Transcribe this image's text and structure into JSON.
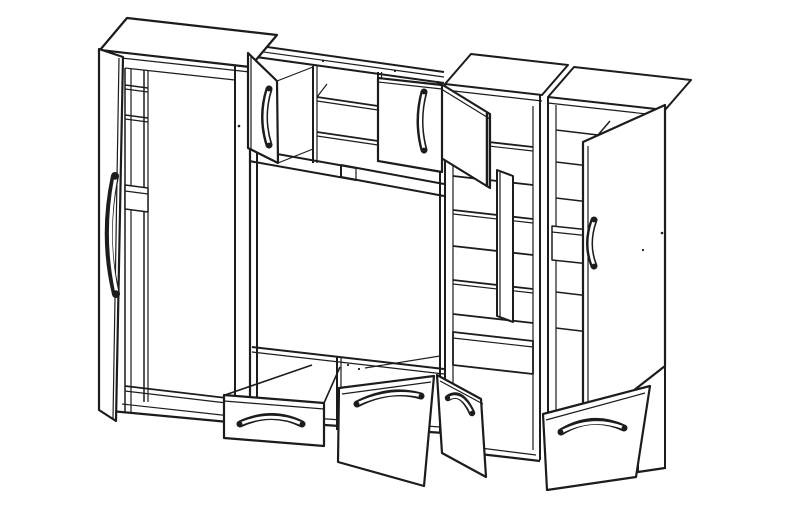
{
  "illustration": {
    "description": "Black-and-white isometric line drawing of a living-room wall unit with open doors, drawers and shelves",
    "background": "#ffffff",
    "line_color": "#1c1c1c",
    "canvas": {
      "width": 787,
      "height": 505
    },
    "components": [
      "left-tall-wardrobe",
      "wardrobe-open-door",
      "wardrobe-interior-shelves",
      "upper-wall-cabinet",
      "wall-cabinet-left-door",
      "wall-cabinet-open-shelves",
      "wall-cabinet-right-door",
      "floating-shelf-rails",
      "tv-open-bay",
      "base-cabinet",
      "open-drawer",
      "open-flap-door",
      "open-base-door",
      "display-cabinet",
      "display-cabinet-upper-door",
      "display-cabinet-lower-door",
      "right-tall-cabinet",
      "right-cabinet-open-door",
      "right-cabinet-bottom-door",
      "curved-door-handles"
    ],
    "shapes": [
      {
        "n": "midwall-top-rail-back",
        "k": "line",
        "p": "246,44 444,72",
        "w": 2
      },
      {
        "n": "midwall-top-rail-mid",
        "k": "line",
        "p": "249,50 444,77",
        "w": 1.2
      },
      {
        "n": "midwall-top-rail-front",
        "k": "line",
        "p": "249,56 444,83",
        "w": 2
      },
      {
        "n": "wallcab-divider-left",
        "k": "line",
        "p": "313,66 313,163",
        "w": 2
      },
      {
        "n": "wallcab-divider-left-inner",
        "k": "line",
        "p": "317,66 317,163",
        "w": 1.2
      },
      {
        "n": "wallcab-shelf-upper",
        "k": "line",
        "p": "317,97 378,106",
        "w": 1.8
      },
      {
        "n": "wallcab-shelf-upper-edge",
        "k": "line",
        "p": "317,101 378,110",
        "w": 1.2
      },
      {
        "n": "wallcab-shelf-depth-tick-left",
        "k": "line",
        "p": "317,97 327,84",
        "w": 1.2
      },
      {
        "n": "wallcab-shelf-depth-tick-right",
        "k": "line",
        "p": "378,106 388,93",
        "w": 1.2
      },
      {
        "n": "wallcab-shelf-lower",
        "k": "line",
        "p": "317,132 378,141",
        "w": 1.8
      },
      {
        "n": "wallcab-shelf-lower-edge",
        "k": "line",
        "p": "317,136 378,145",
        "w": 1.2
      },
      {
        "n": "wallcab-divider-right",
        "k": "line",
        "p": "378,72 378,162",
        "w": 2
      },
      {
        "n": "wallcab-divider-right-inner",
        "k": "line",
        "p": "381.5,72 381.5,162",
        "w": 1.2
      },
      {
        "n": "wallcab-bottom-rail-top",
        "k": "line",
        "p": "249,149 356,168",
        "w": 2
      },
      {
        "n": "wallcab-bottom-rail-bottom",
        "k": "line",
        "p": "249,161 356,180",
        "w": 2
      },
      {
        "n": "floating-rail-top",
        "k": "line",
        "p": "341,165 444,184",
        "w": 2
      },
      {
        "n": "floating-rail-bottom",
        "k": "line",
        "p": "341,177 444,196",
        "w": 2
      },
      {
        "n": "floating-rail-end",
        "k": "line",
        "p": "341,165 341,177",
        "w": 2
      },
      {
        "n": "floating-rail-divider",
        "k": "line",
        "p": "356,168 356,181",
        "w": 1.2
      },
      {
        "n": "tv-bay-left-wall",
        "k": "line",
        "p": "257,70 257,420",
        "w": 2
      },
      {
        "n": "tv-bay-right-wall",
        "k": "line",
        "p": "440,86 440,433",
        "w": 2
      },
      {
        "n": "tv-base-top-edge",
        "k": "line",
        "p": "252,347 444,369",
        "w": 2
      },
      {
        "n": "tv-base-top-inner",
        "k": "line",
        "p": "252,352 444,374",
        "w": 1.2
      },
      {
        "n": "base-divider",
        "k": "line",
        "p": "337,356 337,430",
        "w": 2
      },
      {
        "n": "base-divider-inner",
        "k": "line",
        "p": "341,357 341,430",
        "w": 1.2
      },
      {
        "n": "base-right-depth-edge",
        "k": "line",
        "p": "365,368 440,356",
        "w": 1.2
      },
      {
        "n": "base-bottom-edge",
        "k": "line",
        "p": "250,420 444,433",
        "w": 2.2
      },
      {
        "n": "base-plinth-line",
        "k": "line",
        "p": "256,414 440,427",
        "w": 1.2
      },
      {
        "n": "right-cabinet-top-panel",
        "k": "poly",
        "p": "548,97 574,67 691,80 665,110",
        "w": 2
      },
      {
        "n": "right-cabinet-top-front-edge",
        "k": "line",
        "p": "548,103 665,116",
        "w": 1.2
      },
      {
        "n": "right-cabinet-left-edge",
        "k": "line",
        "p": "548,97 548,458",
        "w": 2
      },
      {
        "n": "right-cabinet-right-edge",
        "k": "line",
        "p": "665,110 665,469",
        "w": 2
      },
      {
        "n": "right-cabinet-inner-left",
        "k": "line",
        "p": "556,105 556,452",
        "w": 1.2
      },
      {
        "n": "right-cabinet-shelf-1",
        "k": "line",
        "p": "556,130 598,135 610,121",
        "w": 1.5
      },
      {
        "n": "right-cabinet-shelf-2",
        "k": "line",
        "p": "556,162 598,167 610,153",
        "w": 1.5
      },
      {
        "n": "right-cabinet-shelf-3",
        "k": "line",
        "p": "556,198 598,203 610,189",
        "w": 1.5
      },
      {
        "n": "right-cabinet-drawer-box",
        "k": "poly",
        "p": "552,226 590,230 590,264 552,260",
        "w": 1.5
      },
      {
        "n": "right-cabinet-drawer-box-edge",
        "k": "line",
        "p": "552,232 590,236",
        "w": 1.2
      },
      {
        "n": "right-cabinet-shelf-4",
        "k": "line",
        "p": "556,292 598,297 610,283",
        "w": 1.5
      },
      {
        "n": "right-cabinet-shelf-5",
        "k": "line",
        "p": "556,328 598,333 610,319",
        "w": 1.5
      },
      {
        "n": "right-cabinet-bottom-edge",
        "k": "line",
        "p": "548,458 638,472 665,468",
        "w": 2.2
      },
      {
        "n": "right-cabinet-plinth-line",
        "k": "line",
        "p": "552,452 634,466",
        "w": 1.2
      },
      {
        "n": "right-cabinet-side-lower-edge",
        "k": "line",
        "p": "638,380 638,472",
        "w": 2
      },
      {
        "n": "right-cabinet-open-door",
        "k": "poly",
        "p": "583,142 665,105 665,366 583,430",
        "w": 2.2
      },
      {
        "n": "right-cabinet-door-edge",
        "k": "line",
        "p": "588,146 588,426",
        "w": 1.2
      },
      {
        "n": "right-cabinet-door-handle",
        "k": "path",
        "d": "M594,220 Q585,244 594,266",
        "w": 7
      },
      {
        "n": "right-cabinet-door-handle-inner",
        "k": "path",
        "d": "M594,221 Q586,244 594,265",
        "w": 3,
        "c": "#ffffff"
      },
      {
        "n": "right-cabinet-door-handle-cap-top",
        "k": "dot",
        "p": "594,220,2.4"
      },
      {
        "n": "right-cabinet-door-handle-cap-bottom",
        "k": "dot",
        "p": "594,266,2.4"
      },
      {
        "n": "display-cabinet-top-panel",
        "k": "poly",
        "p": "445,84 471,54 568,65 542,95",
        "w": 2
      },
      {
        "n": "display-cabinet-top-front-edge",
        "k": "line",
        "p": "445,90 542,101",
        "w": 1.2
      },
      {
        "n": "display-cabinet-left-edge",
        "k": "line",
        "p": "445,84 445,450",
        "w": 2
      },
      {
        "n": "display-cabinet-right-edge",
        "k": "line",
        "p": "540,95 540,460",
        "w": 2
      },
      {
        "n": "display-cabinet-inner-left",
        "k": "line",
        "p": "453,96 453,440",
        "w": 1.2
      },
      {
        "n": "display-cabinet-inner-right",
        "k": "line",
        "p": "533,106 533,450",
        "w": 1.2
      },
      {
        "n": "display-shelf-1",
        "k": "line",
        "p": "453,138 533,147",
        "w": 1.8
      },
      {
        "n": "display-shelf-1-edge",
        "k": "line",
        "p": "453,142 533,151",
        "w": 1.2
      },
      {
        "n": "display-shelf-2",
        "k": "line",
        "p": "453,176 533,185",
        "w": 1.8
      },
      {
        "n": "display-shelf-3",
        "k": "line",
        "p": "453,210 533,219",
        "w": 1.8
      },
      {
        "n": "display-shelf-3-edge",
        "k": "line",
        "p": "453,214 533,223",
        "w": 1.2
      },
      {
        "n": "display-shelf-4",
        "k": "line",
        "p": "453,246 533,255",
        "w": 1.8
      },
      {
        "n": "display-shelf-5",
        "k": "line",
        "p": "453,280 533,289",
        "w": 1.8
      },
      {
        "n": "display-shelf-5-edge",
        "k": "line",
        "p": "453,284 533,293",
        "w": 1.2
      },
      {
        "n": "display-shelf-6",
        "k": "line",
        "p": "453,314 533,323",
        "w": 1.8
      },
      {
        "n": "display-bottom-drawer-box",
        "k": "poly",
        "p": "453,332 533,341 533,374 453,365",
        "w": 1.8
      },
      {
        "n": "display-bottom-drawer-edge",
        "k": "line",
        "p": "453,338 533,347",
        "w": 1.2
      },
      {
        "n": "display-cabinet-bottom-edge",
        "k": "line",
        "p": "445,450 540,461",
        "w": 2.2
      },
      {
        "n": "display-cabinet-plinth-line",
        "k": "line",
        "p": "449,444 536,455",
        "w": 1.2
      },
      {
        "n": "display-upper-door",
        "k": "poly",
        "p": "438,82 490,114 490,188 438,156",
        "w": 2.2
      },
      {
        "n": "display-upper-door-thickness",
        "k": "line",
        "p": "438,87 490,119",
        "w": 1.2
      },
      {
        "n": "display-upper-door-free-edge",
        "k": "line",
        "p": "487,113 487,187",
        "w": 2.5
      },
      {
        "n": "display-lower-door",
        "k": "poly",
        "p": "497,170 513,176 513,322 497,316",
        "w": 2
      },
      {
        "n": "display-lower-door-edge",
        "k": "line",
        "p": "500,172 500,318",
        "w": 1.2
      },
      {
        "n": "wardrobe-top-panel",
        "k": "poly",
        "p": "100,50 127,18 277,35 250,67",
        "w": 2.2
      },
      {
        "n": "wardrobe-top-front-edge",
        "k": "line",
        "p": "103,56 250,72",
        "w": 1.2
      },
      {
        "n": "wardrobe-left-edge",
        "k": "line",
        "p": "100,50 100,410",
        "w": 2.2
      },
      {
        "n": "wardrobe-right-edge",
        "k": "line",
        "p": "250,67 250,424",
        "w": 2.2
      },
      {
        "n": "wardrobe-bottom-edge",
        "k": "line",
        "p": "100,410 250,424",
        "w": 2.2
      },
      {
        "n": "wardrobe-plinth-line",
        "k": "line",
        "p": "122,404 240,417",
        "w": 1.2
      },
      {
        "n": "wardrobe-right-stile",
        "k": "line",
        "p": "235,65 235,421",
        "w": 2
      },
      {
        "n": "wardrobe-interior-top",
        "k": "line",
        "p": "125,68 235,80",
        "w": 1.2
      },
      {
        "n": "wardrobe-interior-left",
        "k": "line",
        "p": "125,68 125,412",
        "w": 1.5
      },
      {
        "n": "wardrobe-interior-left-inner",
        "k": "line",
        "p": "131,69 131,413",
        "w": 1.2
      },
      {
        "n": "wardrobe-partition",
        "k": "line",
        "p": "144,70 144,402",
        "w": 1.5
      },
      {
        "n": "wardrobe-partition-inner",
        "k": "line",
        "p": "148,70 148,402",
        "w": 1.2
      },
      {
        "n": "wardrobe-shelf-1",
        "k": "line",
        "p": "125,85 148,88",
        "w": 1.5
      },
      {
        "n": "wardrobe-shelf-1-edge",
        "k": "line",
        "p": "125,89 148,92",
        "w": 1.2
      },
      {
        "n": "wardrobe-shelf-2",
        "k": "line",
        "p": "125,115 148,118",
        "w": 1.5
      },
      {
        "n": "wardrobe-shelf-2-edge",
        "k": "line",
        "p": "125,119 148,122",
        "w": 1.2
      },
      {
        "n": "wardrobe-shelf-box",
        "k": "poly",
        "p": "125,185 148,188 148,212 125,209",
        "w": 1.5
      },
      {
        "n": "wardrobe-shelf-box-edge",
        "k": "line",
        "p": "125,191 148,194",
        "w": 1.2
      },
      {
        "n": "wardrobe-bottom-shelf",
        "k": "line",
        "p": "125,386 235,399",
        "w": 1.8
      },
      {
        "n": "wardrobe-bottom-shelf-edge",
        "k": "line",
        "p": "125,391 235,404",
        "w": 1.2
      },
      {
        "n": "wardrobe-open-door",
        "k": "poly",
        "p": "99,49 123,57 116,421 99,410",
        "w": 2.2
      },
      {
        "n": "wardrobe-door-inner-edge",
        "k": "line",
        "p": "119,58 113,419",
        "w": 1.2
      },
      {
        "n": "wardrobe-door-handle",
        "k": "path",
        "d": "M115,176 Q102,236 116,294",
        "w": 8
      },
      {
        "n": "wardrobe-door-handle-inner",
        "k": "path",
        "d": "M115.5,179 Q105,236 116.5,291",
        "w": 3.2,
        "c": "#ffffff"
      },
      {
        "n": "wardrobe-door-handle-cap-top",
        "k": "dot",
        "p": "115,177,2.8"
      },
      {
        "n": "wardrobe-door-handle-cap-bottom",
        "k": "dot",
        "p": "116,293,2.8"
      },
      {
        "n": "wallcab-left-door",
        "k": "poly",
        "p": "248,53 277,81 278,163 248,148",
        "w": 2.2
      },
      {
        "n": "wallcab-left-door-edge",
        "k": "line",
        "p": "251,55 251,149",
        "w": 1.2
      },
      {
        "n": "wallcab-left-door-gap-top",
        "k": "line",
        "p": "277,81 313,67",
        "w": 1.2
      },
      {
        "n": "wallcab-left-door-gap-bottom",
        "k": "line",
        "p": "278,163 313,149",
        "w": 1.2
      },
      {
        "n": "wallcab-left-door-handle",
        "k": "path",
        "d": "M269,89 Q260,117 269,145",
        "w": 7
      },
      {
        "n": "wallcab-left-door-handle-inner",
        "k": "path",
        "d": "M269,90 Q261,117 269,144",
        "w": 3,
        "c": "#ffffff"
      },
      {
        "n": "wallcab-left-handle-cap-top",
        "k": "dot",
        "p": "269,89,2.4"
      },
      {
        "n": "wallcab-left-handle-cap-bottom",
        "k": "dot",
        "p": "269,145,2.4"
      },
      {
        "n": "wallcab-right-door",
        "k": "poly",
        "p": "378,78 442,85 442,172 378,161",
        "w": 2.2
      },
      {
        "n": "wallcab-right-door-thickness",
        "k": "line",
        "p": "378,82 442,89",
        "w": 1.2
      },
      {
        "n": "wallcab-right-door-handle",
        "k": "path",
        "d": "M424,92 Q416,121 424,150",
        "w": 7
      },
      {
        "n": "wallcab-right-door-handle-inner",
        "k": "path",
        "d": "M424,93 Q417,121 424,149",
        "w": 3,
        "c": "#ffffff"
      },
      {
        "n": "wallcab-right-handle-cap-top",
        "k": "dot",
        "p": "424,92,2.4"
      },
      {
        "n": "wallcab-right-handle-cap-bottom",
        "k": "dot",
        "p": "424,150,2.4"
      },
      {
        "n": "drawer-side-top-edge",
        "k": "line",
        "p": "225,395 312,365",
        "w": 1.6
      },
      {
        "n": "drawer-right-connector",
        "k": "line",
        "p": "324,403 340,367",
        "w": 1.6
      },
      {
        "n": "open-drawer-front",
        "k": "poly",
        "p": "224,395 324,403 324,446 224,438",
        "w": 2.2
      },
      {
        "n": "open-drawer-front-edge",
        "k": "line",
        "p": "224,401 324,409",
        "w": 1.2
      },
      {
        "n": "drawer-handle",
        "k": "path",
        "d": "M240,424 Q272,409 302,424",
        "w": 7
      },
      {
        "n": "drawer-handle-inner",
        "k": "path",
        "d": "M241,423.5 Q272,411 301,423.5",
        "w": 3,
        "c": "#ffffff"
      },
      {
        "n": "drawer-handle-cap-left",
        "k": "dot",
        "p": "240,424,2.4"
      },
      {
        "n": "drawer-handle-cap-right",
        "k": "dot",
        "p": "302,424,2.4"
      },
      {
        "n": "open-flap-door",
        "k": "poly",
        "p": "339,388 434,376 424,486 338,462",
        "w": 2.2
      },
      {
        "n": "flap-door-thickness",
        "k": "line",
        "p": "342,394 431,382",
        "w": 1.2
      },
      {
        "n": "flap-door-handle",
        "k": "path",
        "d": "M357,404 Q390,387 421,396",
        "w": 7
      },
      {
        "n": "flap-door-handle-inner",
        "k": "path",
        "d": "M358,403.5 Q390,389 420,395.5",
        "w": 3,
        "c": "#ffffff"
      },
      {
        "n": "flap-handle-cap-left",
        "k": "dot",
        "p": "357,404,2.4"
      },
      {
        "n": "flap-handle-cap-right",
        "k": "dot",
        "p": "421,396,2.4"
      },
      {
        "n": "open-base-door",
        "k": "poly",
        "p": "437,375 481,399 486,477 442,453",
        "w": 2.2
      },
      {
        "n": "base-door-thickness",
        "k": "line",
        "p": "440,381 483,404",
        "w": 1.2
      },
      {
        "n": "base-door-handle",
        "k": "path",
        "d": "M448,398 Q461,389 472,413",
        "w": 6.5
      },
      {
        "n": "base-door-handle-inner",
        "k": "path",
        "d": "M448.5,398.5 Q461,391 471.5,412",
        "w": 2.6,
        "c": "#ffffff"
      },
      {
        "n": "base-door-handle-cap-top",
        "k": "dot",
        "p": "448,398,2.2"
      },
      {
        "n": "base-door-handle-cap-bottom",
        "k": "dot",
        "p": "472,413,2.2"
      },
      {
        "n": "right-cabinet-bottom-door",
        "k": "poly",
        "p": "543,414 650,386 636,477 547,490",
        "w": 2.2
      },
      {
        "n": "right-bottom-door-thickness",
        "k": "line",
        "p": "546,420 645,393",
        "w": 1.2
      },
      {
        "n": "right-bottom-door-handle",
        "k": "path",
        "d": "M561,432 Q592,413 624,428",
        "w": 7
      },
      {
        "n": "right-bottom-door-handle-inner",
        "k": "path",
        "d": "M562,431.5 Q592,416 623,427.5",
        "w": 3,
        "c": "#ffffff"
      },
      {
        "n": "right-bottom-handle-cap-left",
        "k": "dot",
        "p": "561,432,2.4"
      },
      {
        "n": "right-bottom-handle-cap-right",
        "k": "dot",
        "p": "624,428,2.4"
      },
      {
        "n": "print-speck-1",
        "k": "dot",
        "p": "239,126,1.3"
      },
      {
        "n": "print-speck-2",
        "k": "dot",
        "p": "662,233,1.3"
      },
      {
        "n": "print-speck-3",
        "k": "dot",
        "p": "643,250,1.1"
      },
      {
        "n": "print-speck-4",
        "k": "dot",
        "p": "348,365,1.1"
      },
      {
        "n": "print-speck-5",
        "k": "dot",
        "p": "359,369,1.1"
      },
      {
        "n": "print-speck-6",
        "k": "dot",
        "p": "323,61,1.1"
      },
      {
        "n": "print-speck-7",
        "k": "dot",
        "p": "395,71,1.1"
      }
    ]
  }
}
